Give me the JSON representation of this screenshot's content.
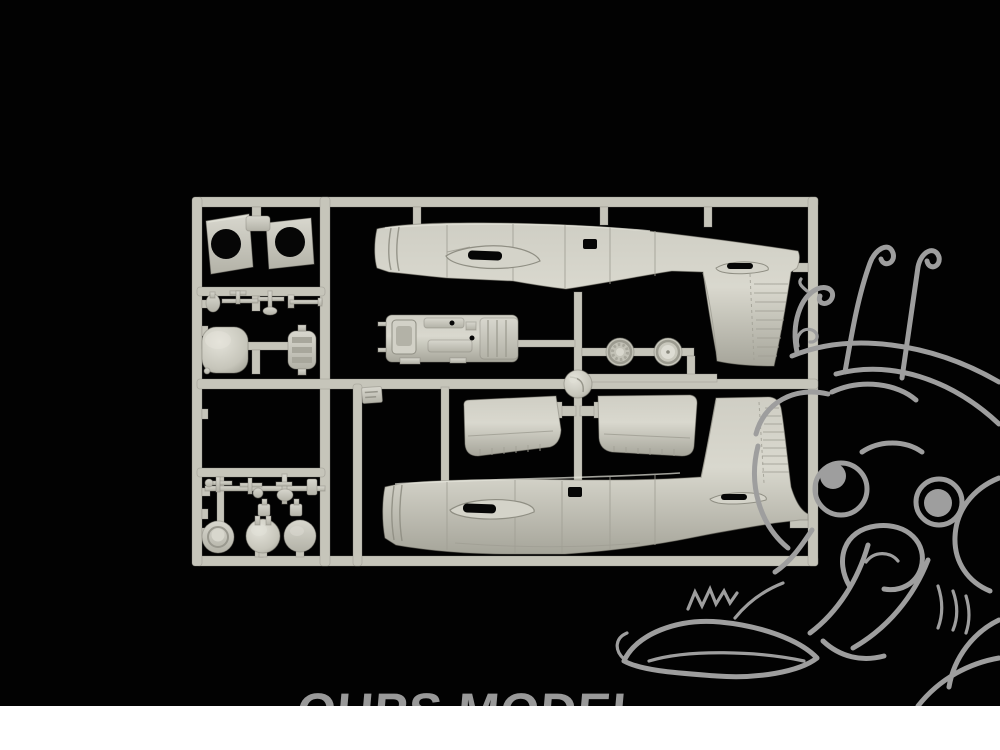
{
  "photo": {
    "subject": "model kit sprue",
    "parts_visible": [
      "fuselage half upper",
      "fuselage half lower",
      "tailplane left",
      "tailplane right",
      "cockpit floor",
      "main wheels",
      "spinner",
      "engine cowling",
      "cowl flap panels",
      "gear doors",
      "small detail parts"
    ]
  },
  "watermark": {
    "text": "OUPS MODEL"
  },
  "mascot": {
    "name": "oups-model-mascot"
  },
  "colors": {
    "bg": "#020202",
    "plastic": "#c6c5ba",
    "plastic_light": "#dcdbd2",
    "plastic_dark": "#a5a49a",
    "hole": "#060606",
    "mascot": "#9e9e9e",
    "wm": "#999999",
    "footer": "#ffffff"
  }
}
